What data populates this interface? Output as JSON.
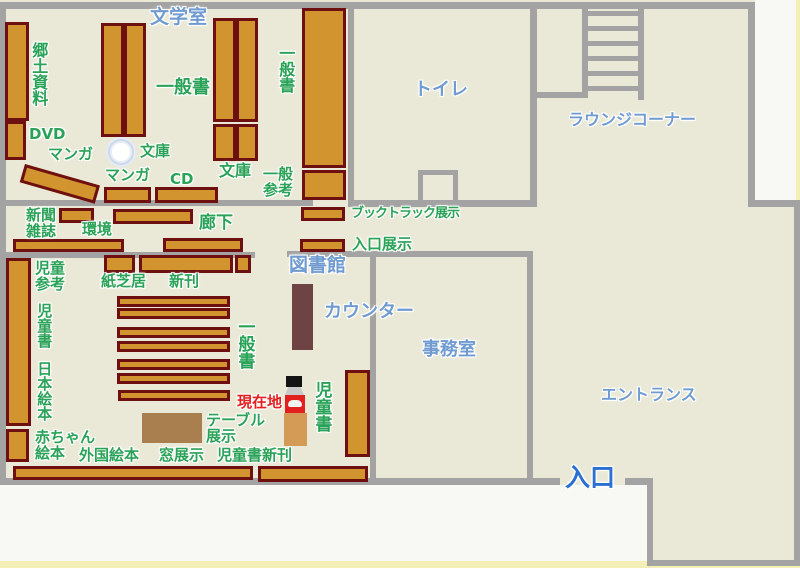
{
  "map_title": "library-floor-map",
  "rooms": {
    "bungaku_shitsu": "文学室",
    "toilet": "トイレ",
    "lounge_corner": "ラウンジコーナー",
    "toshokan": "図書館",
    "counter": "カウンター",
    "office": "事務室",
    "entrance_hall": "エントランス",
    "entrance": "入口"
  },
  "shelf_labels": {
    "kyodo_shiryo": "郷土資料",
    "dvd": "DVD",
    "manga_1": "マンガ",
    "ippansho_main": "一般書",
    "bunko_pillar": "文庫",
    "manga_2": "マンガ",
    "cd": "CD",
    "bunko_2": "文庫",
    "ippansho_wall": "一般書",
    "ippan_sanko": "一般\n参考",
    "booktruck_tenji": "ブックトラック展示",
    "iriguchi_tenji": "入口展示",
    "shinbun_zasshi": "新聞\n雑誌",
    "kankyo": "環境",
    "rouka": "廊下",
    "jido_sanko": "児童\n参考",
    "kamishibai": "紙芝居",
    "shinkan": "新刊",
    "jidosho_left": "児童書",
    "nihon_ehon": "日本絵本",
    "ippansho_child": "一般書",
    "akachan_ehon": "赤ちゃん\n絵本",
    "gaikoku_ehon": "外国絵本",
    "mado_tenji": "窓展示",
    "jidosho_shinkan": "児童書新刊",
    "table_tenji": "テーブル\n展示",
    "jidosho_right": "児童書"
  },
  "marker": {
    "genzaichi": "現在地"
  },
  "colors": {
    "floor": "#eae9d7",
    "outside": "#f8f8f4",
    "wall": "#a3a3a3",
    "shelf": "#d1942f",
    "shelfborder": "#6e1010",
    "counter": "#6e4343",
    "table": "#a97f4f",
    "stand": "#d39b56",
    "green": "#2aa257",
    "blue": "#6f9bd1",
    "blued": "#2a6fd2",
    "red": "#e32020",
    "edge": "#f3eca6"
  }
}
